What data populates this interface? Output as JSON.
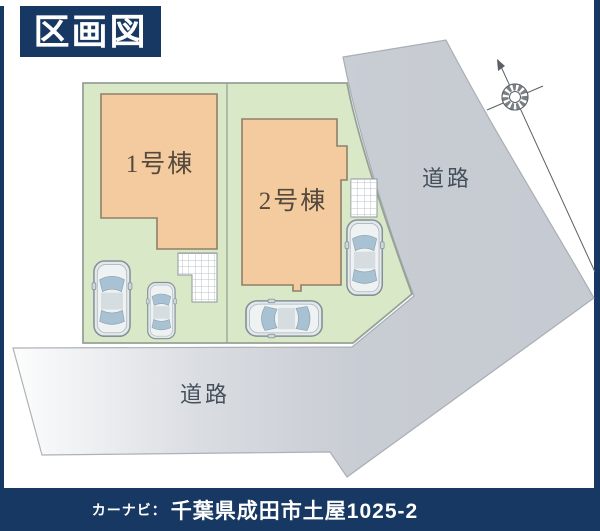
{
  "title": {
    "label": "区画図"
  },
  "footer": {
    "prefix": "カーナビ：",
    "address": "千葉県成田市土屋1025-2"
  },
  "plan": {
    "buildings": [
      {
        "id": "building-1",
        "label": "1号棟"
      },
      {
        "id": "building-2",
        "label": "2号棟"
      }
    ],
    "roads": [
      {
        "id": "road-right",
        "label": "道路"
      },
      {
        "id": "road-bottom",
        "label": "道路"
      }
    ],
    "compass": {
      "icon": "north-compass-icon"
    },
    "cars_count": 4,
    "hatch_areas_count": 2
  },
  "colors": {
    "navy": "#173862",
    "parcel_green": "#d9e8c6",
    "parcel_border": "#96a198",
    "building_tan": "#f3cb9f",
    "building_border": "#8f7f6b",
    "road_gray": "#c8ccd3",
    "road_border": "#a0a6ad",
    "label_dark": "#54493c"
  }
}
